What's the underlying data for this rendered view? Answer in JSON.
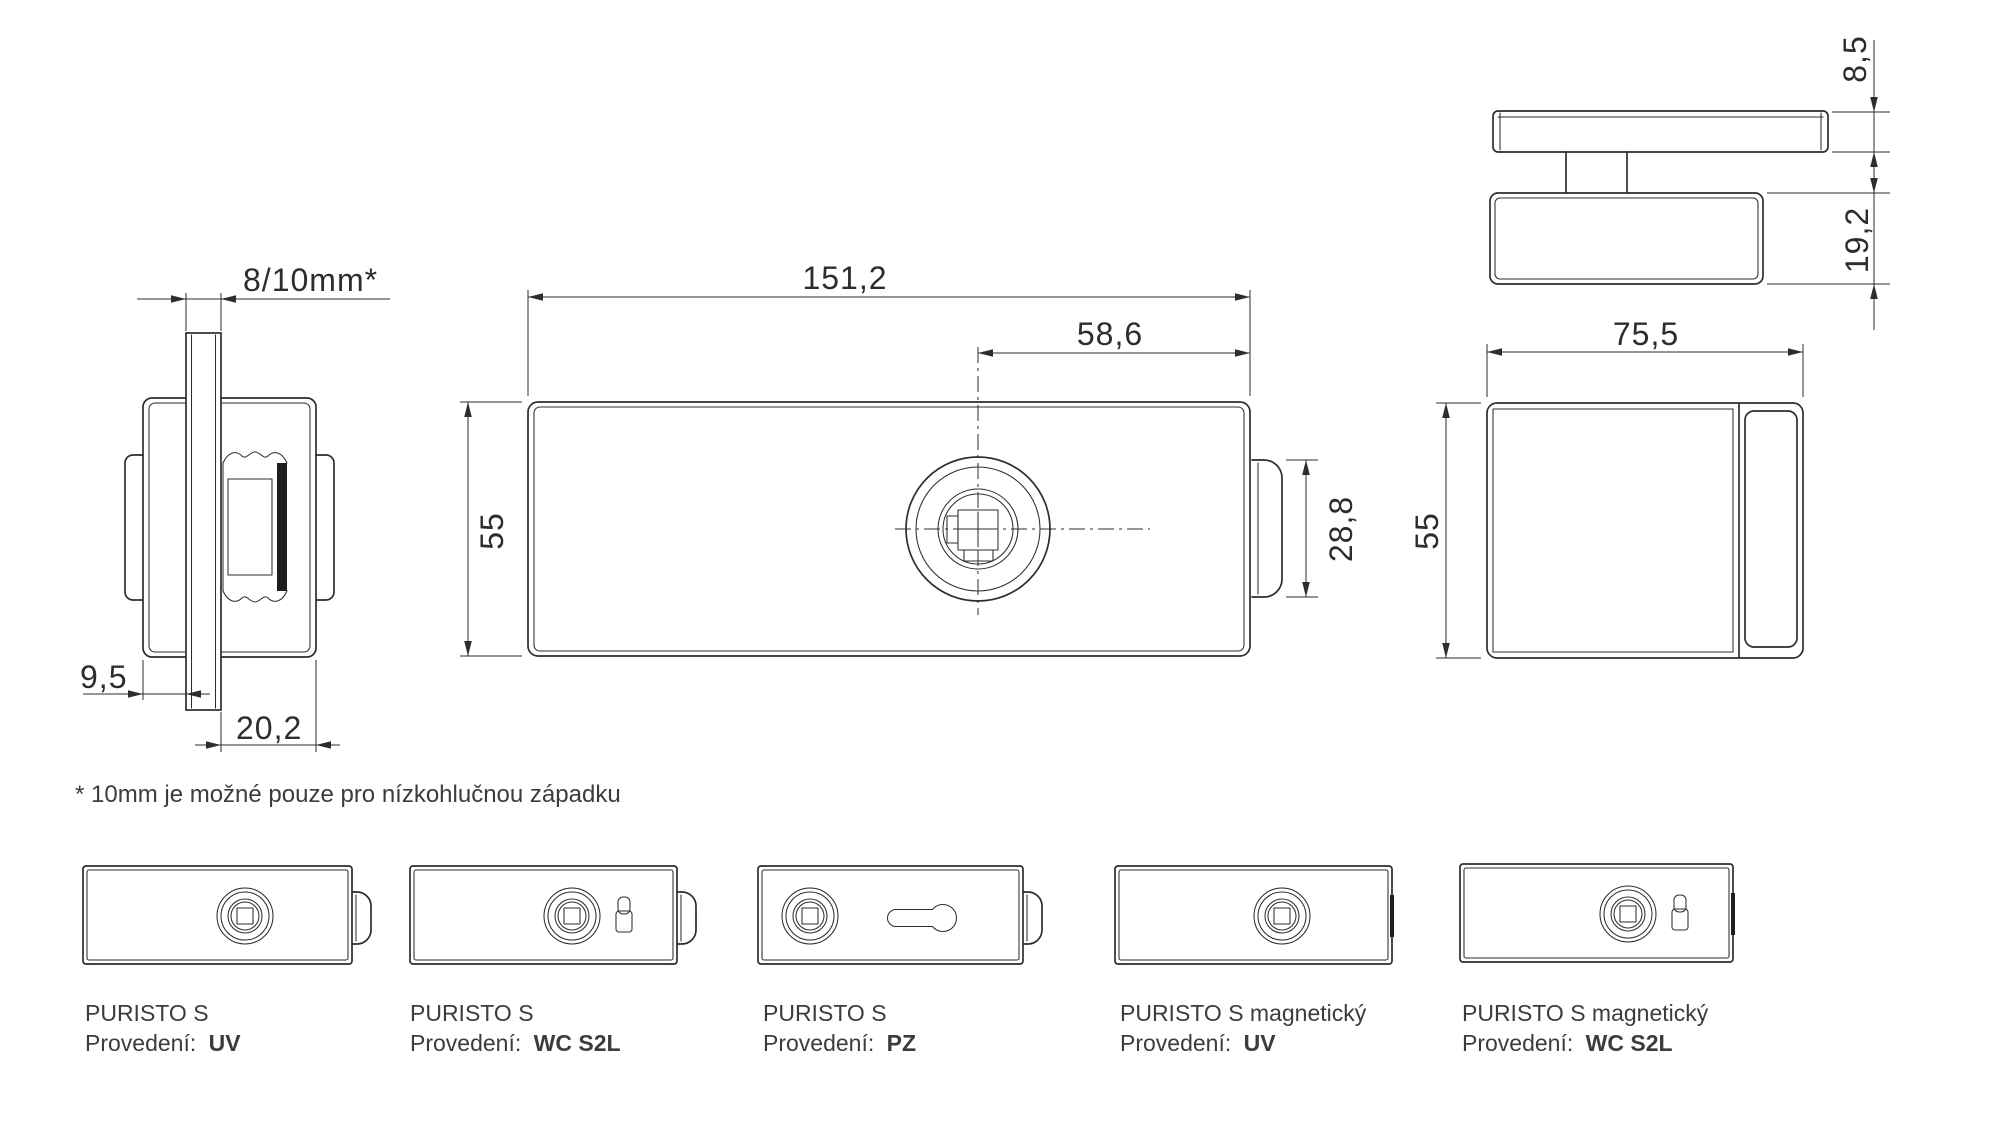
{
  "drawing_title": "PURISTO S glass door lock technical drawing",
  "views": {
    "side": {
      "glass_thickness": "8/10mm*",
      "glass_offset": "9,5",
      "body_depth": "20,2"
    },
    "front": {
      "width": "151,2",
      "spindle_to_edge": "58,6",
      "height": "55",
      "latch_height": "28,8"
    },
    "top": {
      "cover_thickness": "8,5",
      "body_thickness": "19,2"
    },
    "right": {
      "width": "75,5",
      "height": "55"
    }
  },
  "footnote": "* 10mm je možné pouze pro nízkohlučnou západku",
  "variants": [
    {
      "name": "PURISTO S",
      "finish_label": "Provedení:",
      "finish_value": "UV"
    },
    {
      "name": "PURISTO S",
      "finish_label": "Provedení:",
      "finish_value": "WC S2L"
    },
    {
      "name": "PURISTO S",
      "finish_label": "Provedení:",
      "finish_value": "PZ"
    },
    {
      "name": "PURISTO S magnetický",
      "finish_label": "Provedení:",
      "finish_value": "UV"
    },
    {
      "name": "PURISTO S magnetický",
      "finish_label": "Provedení:",
      "finish_value": "WC S2L"
    }
  ],
  "colors": {
    "line": "#2d2d2d",
    "dim_text": "#2d2d2d",
    "label_text": "#3c3c3c",
    "background": "#ffffff"
  }
}
